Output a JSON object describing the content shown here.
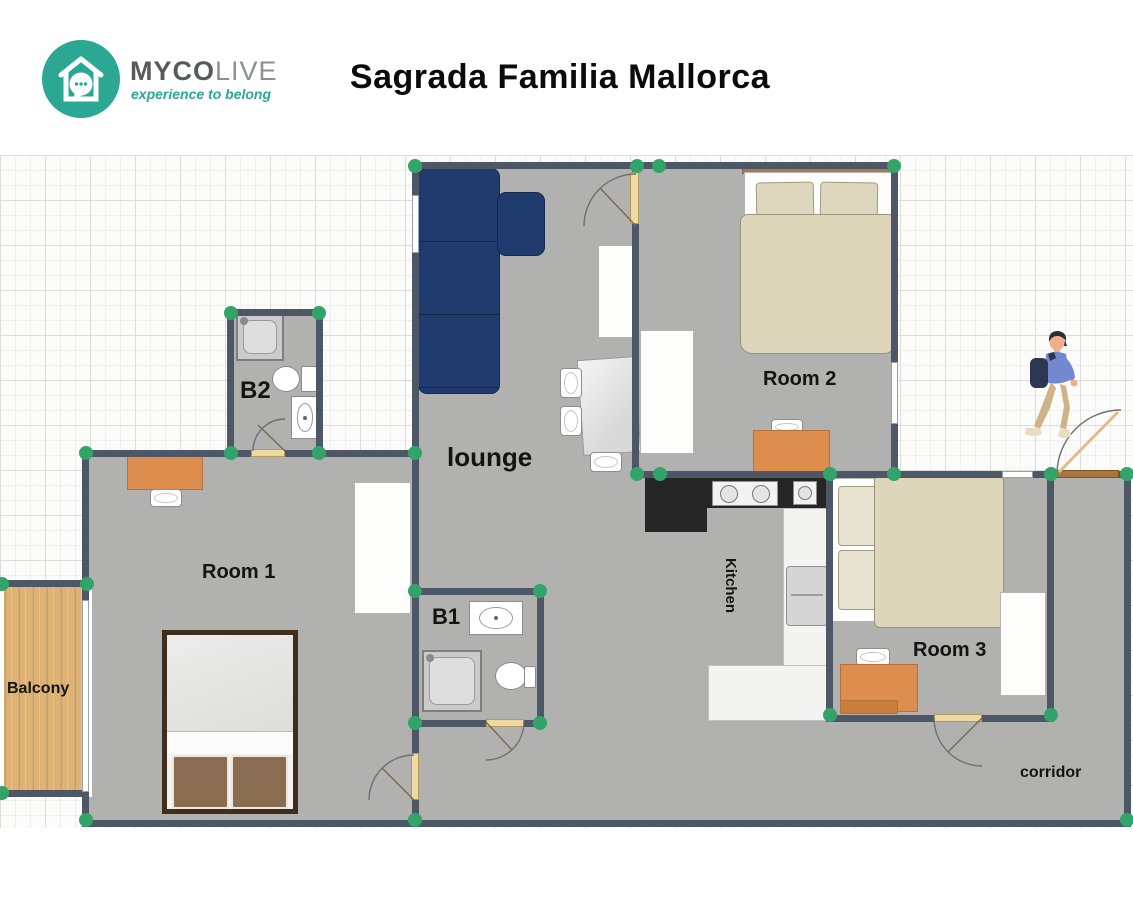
{
  "header": {
    "logo": {
      "word_primary": "MYCO",
      "word_secondary": "LIVE",
      "tagline": "experience to belong",
      "icon": "house-chat-bubble-logo-icon"
    },
    "title": "Sagrada Familia Mallorca"
  },
  "floorplan": {
    "rooms": [
      {
        "id": "lounge",
        "label": "lounge",
        "furniture": [
          "corner-sofa",
          "dining-table",
          "dining-chairs",
          "sideboard"
        ]
      },
      {
        "id": "room1",
        "label": "Room 1",
        "furniture": [
          "double-bed",
          "desk",
          "desk-chair",
          "wardrobe"
        ]
      },
      {
        "id": "room2",
        "label": "Room 2",
        "furniture": [
          "double-bed",
          "desk",
          "desk-chair",
          "wardrobe"
        ]
      },
      {
        "id": "room3",
        "label": "Room 3",
        "furniture": [
          "double-bed",
          "desk",
          "desk-chair",
          "wardrobe"
        ]
      },
      {
        "id": "bath1",
        "label": "B1",
        "furniture": [
          "sink",
          "shower",
          "toilet"
        ]
      },
      {
        "id": "bath2",
        "label": "B2",
        "furniture": [
          "shower",
          "toilet",
          "sink"
        ]
      },
      {
        "id": "kitchen",
        "label": "Kitchen",
        "furniture": [
          "counter",
          "cooktop",
          "kitchen-sink",
          "fridge",
          "island"
        ]
      },
      {
        "id": "corridor",
        "label": "corridor",
        "furniture": []
      },
      {
        "id": "balcony",
        "label": "Balcony",
        "furniture": []
      }
    ],
    "doors": [
      "entry-door",
      "room2-door",
      "room1-door",
      "room3-door",
      "b1-door",
      "b2-door"
    ],
    "person_icon": "walking-person-with-backpack",
    "colors": {
      "wall": "#4d5765",
      "floor": "#b1b1b0",
      "corner_node_green": "#33a469",
      "sofa_navy": "#203c6e",
      "desk_orange": "#dd8e4e",
      "bed_linen_beige": "#ded6bb",
      "balcony_wood": "#ddb273",
      "kitchen_counter_black": "#262626",
      "door_leaf_tan": "#eed9a4",
      "entry_door_brown": "#a9763f",
      "brand_teal": "#2ba794"
    }
  }
}
